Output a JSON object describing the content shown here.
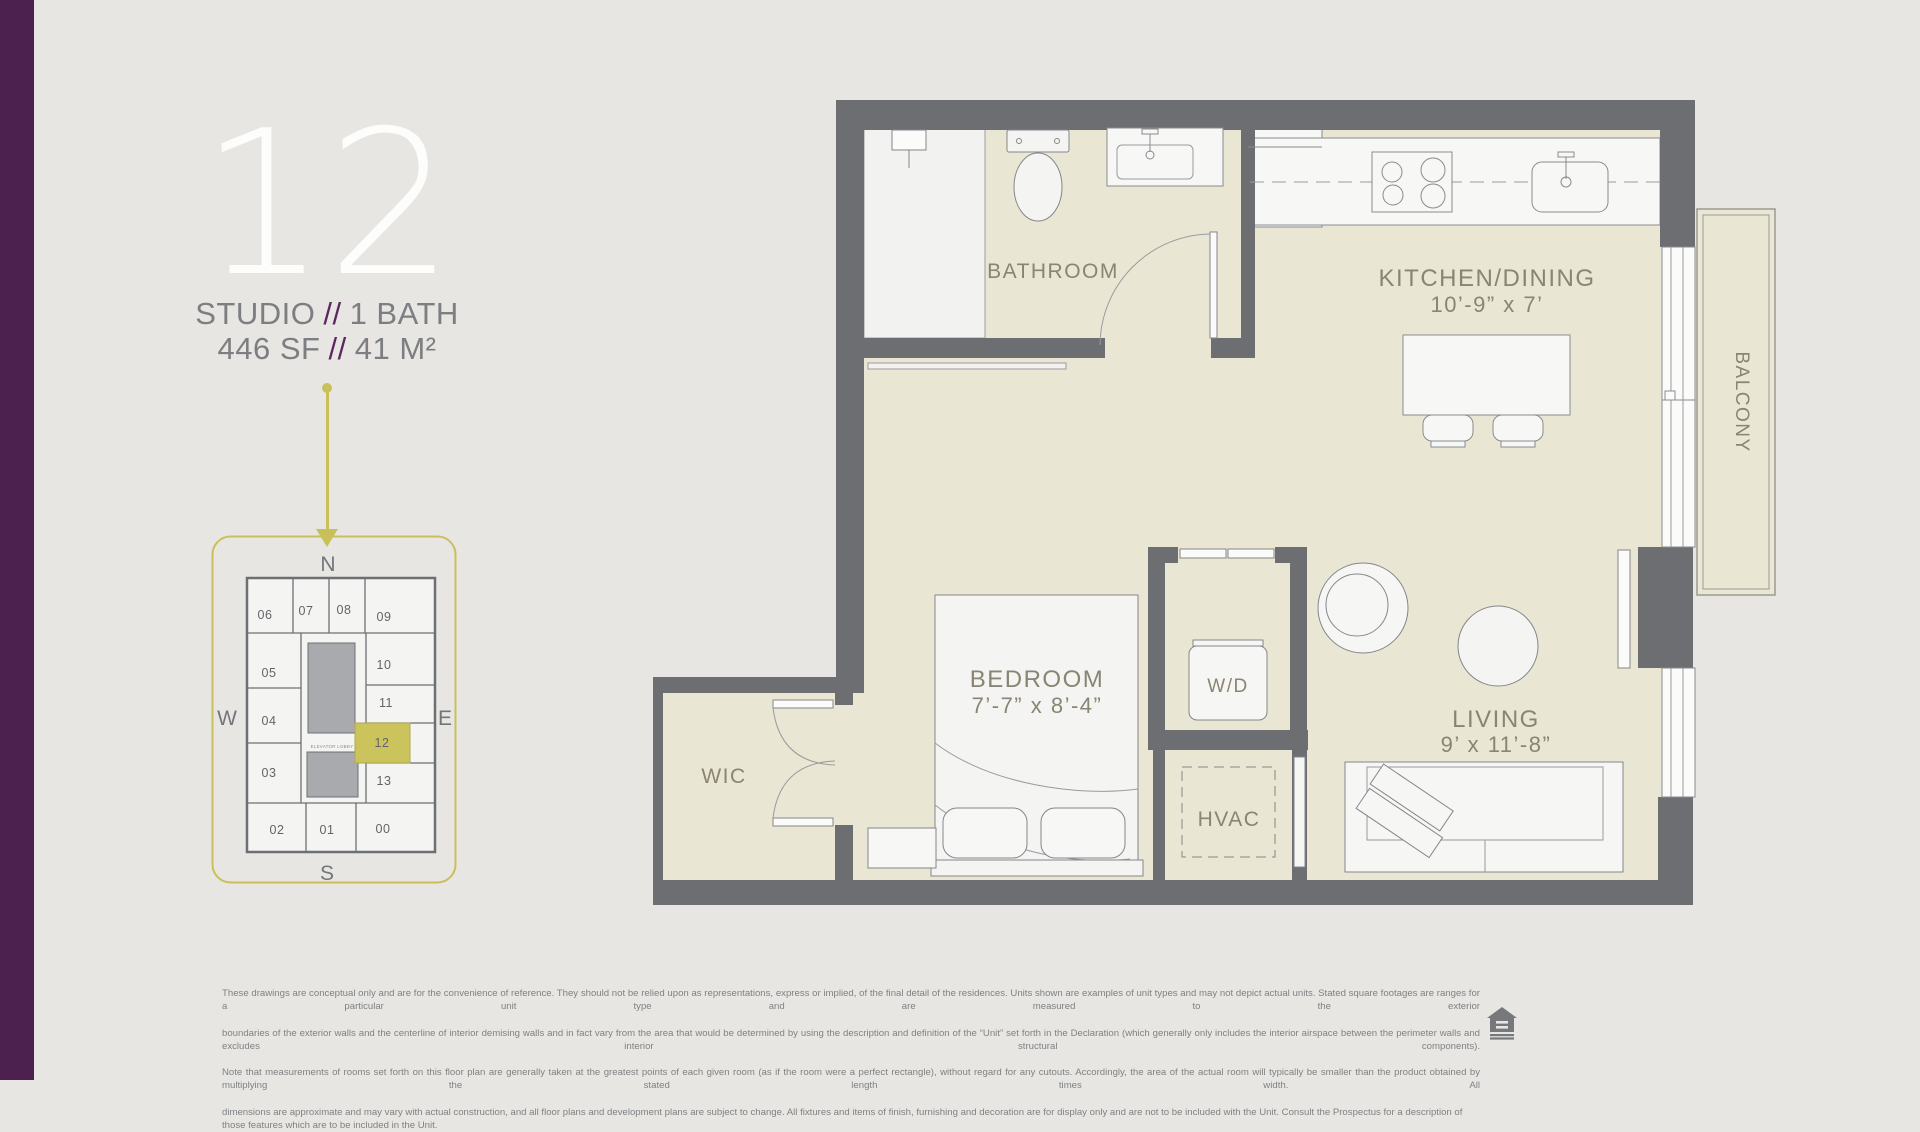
{
  "page": {
    "bg_color": "#e7e6e2",
    "accent_purple": "#4c2150",
    "accent_gold": "#c9c05c",
    "wall_gray": "#6d6e71",
    "floor_beige": "#eae6d4"
  },
  "header": {
    "unit_number": "12",
    "type_label": "STUDIO",
    "separator": "//",
    "bath_label": "1 BATH",
    "area_sf": "446 SF",
    "area_m2": "41 M²"
  },
  "keyplan": {
    "compass": {
      "north": "N",
      "south": "S",
      "west": "W",
      "east": "E"
    },
    "elevator_label": "ELEVATOR LOBBY",
    "highlight_unit": "12",
    "units": [
      "06",
      "07",
      "08",
      "09",
      "05",
      "10",
      "04",
      "11",
      "12",
      "13",
      "03",
      "02",
      "01",
      "00"
    ]
  },
  "floorplan": {
    "rooms": {
      "bathroom": "BATHROOM",
      "kitchen": "KITCHEN/DINING",
      "kitchen_dim": "10’-9” x 7’",
      "balcony": "BALCONY",
      "bedroom": "BEDROOM",
      "bedroom_dim": "7’-7” x 8’-4”",
      "wd": "W/D",
      "wic": "WIC",
      "hvac": "HVAC",
      "living": "LIVING",
      "living_dim": "9’ x 11’-8”"
    }
  },
  "disclaimer": {
    "lines": [
      "These drawings are conceptual only and are for the convenience of reference. They should not be relied upon as representations, express or implied, of the final detail of the residences. Units shown are examples of unit types and may not depict actual units. Stated square footages are ranges for a particular unit type and are measured to the exterior",
      "boundaries of the exterior walls and the centerline of interior demising walls and in fact vary from the area that would be determined by using the description and definition of the “Unit” set forth in the Declaration (which generally only includes the interior airspace between the perimeter walls and excludes interior structural components).",
      "Note that measurements of rooms set forth on this floor plan are generally taken at the greatest points of each given room (as if the room were a perfect rectangle), without regard for any cutouts. Accordingly, the area of the actual room will typically be smaller than the product obtained by multiplying the stated length times width. All",
      "dimensions are approximate and may vary with actual construction, and all floor plans and development plans are subject to change. All fixtures and items of finish, furnishing and decoration are for display only and are not to be included with the Unit. Consult the Prospectus for a description of those features which are to be included in the Unit."
    ],
    "logo": "equal-housing-opportunity"
  }
}
